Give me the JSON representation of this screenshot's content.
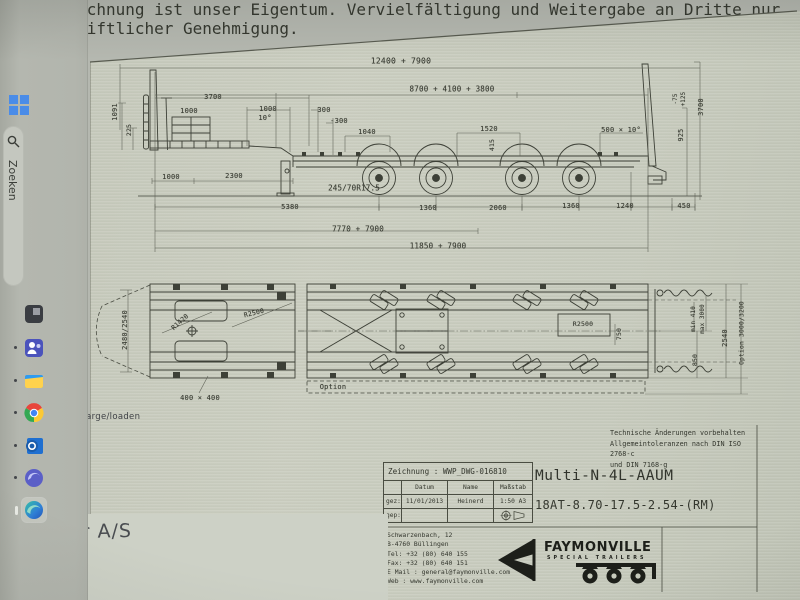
{
  "window": {
    "background": "#b5b8b0",
    "sheet": "#c7cbbd",
    "ink": "#3d4037",
    "accent_blue": "#4a8ce8"
  },
  "taskbar": {
    "search_label": "Zoeken",
    "items": [
      {
        "id": "start",
        "icon": "windows-logo",
        "active": false
      },
      {
        "id": "dark-app",
        "icon": "dark-app",
        "active": false
      },
      {
        "id": "teams",
        "icon": "teams",
        "active": false
      },
      {
        "id": "file-explorer",
        "icon": "file-explorer",
        "active": false
      },
      {
        "id": "chrome",
        "icon": "chrome",
        "active": false
      },
      {
        "id": "outlook",
        "icon": "outlook",
        "active": false
      },
      {
        "id": "edge-insider",
        "icon": "edge-insider",
        "active": false
      },
      {
        "id": "edge",
        "icon": "edge",
        "active": true
      }
    ]
  },
  "overlays": {
    "load_note": "laden/en charge/loaden",
    "partner_note": "artner A/S"
  },
  "drawing": {
    "notes": {
      "tolerances": "Technische Änderungen vorbehalten\nAllgemeintoleranzen nach DIN ISO 2768-c\nund DIN 7168-g"
    },
    "title_block": {
      "zeichnung": "Zeichnung : WWP_DWG-016810",
      "headers": {
        "datum": "Datum",
        "name": "Name",
        "massstab": "Maßstab"
      },
      "rows": {
        "gez_label": "gez:",
        "gez_date": "11/01/2013",
        "gez_name": "Heinerd",
        "scale": "1:50",
        "format": "A3",
        "gep_label": "gep:"
      },
      "model": "Multi-N-4L-AAUM",
      "spec": "18AT-8.70-17.5-2.54-(RM)"
    },
    "footer": {
      "address": "Schwarzenbach, 12\nB-4760 Büllingen\nTel: +32 (80) 640 155\nFax: +32 (80) 640 151\nE Mail : general@faymonville.com\nWeb : www.faymonville.com",
      "brand": {
        "name": "FAYMONVILLE",
        "tagline": "SPECIAL TRAILERS"
      },
      "ownership": "Diese Zeichnung ist unser Eigentum. Vervielfältigung und Weitergabe an Dritte nur nach schriftlicher Genehmigung."
    },
    "labels": [
      {
        "t": "12400 + 7900",
        "x": 401,
        "y": 61,
        "s": 8
      },
      {
        "t": "8700 + 4100 + 3800",
        "x": 452,
        "y": 89,
        "s": 7.5
      },
      {
        "t": "3700",
        "x": 213,
        "y": 97
      },
      {
        "t": "1091",
        "x": 115,
        "y": 112,
        "r": -90
      },
      {
        "t": "225",
        "x": 129,
        "y": 130,
        "r": -90,
        "s": 6.5
      },
      {
        "t": "1000",
        "x": 189,
        "y": 111
      },
      {
        "t": "1000",
        "x": 268,
        "y": 109
      },
      {
        "t": "10°",
        "x": 265,
        "y": 118
      },
      {
        "t": "300",
        "x": 324,
        "y": 110
      },
      {
        "t": "-300",
        "x": 339,
        "y": 121
      },
      {
        "t": "1040",
        "x": 367,
        "y": 132
      },
      {
        "t": "1520",
        "x": 489,
        "y": 129
      },
      {
        "t": "415",
        "x": 492,
        "y": 145,
        "r": -90,
        "s": 6.5
      },
      {
        "t": "500 × 10°",
        "x": 621,
        "y": 130
      },
      {
        "t": "-75",
        "x": 676,
        "y": 99,
        "r": -90,
        "s": 5.8
      },
      {
        "t": "+125",
        "x": 684,
        "y": 99,
        "r": -90,
        "s": 5.8
      },
      {
        "t": "925",
        "x": 681,
        "y": 135,
        "r": -90,
        "s": 6.8
      },
      {
        "t": "3700",
        "x": 701,
        "y": 107,
        "r": -90
      },
      {
        "t": "1000",
        "x": 171,
        "y": 177
      },
      {
        "t": "2300",
        "x": 234,
        "y": 176
      },
      {
        "t": "245/70R17.5",
        "x": 354,
        "y": 188,
        "s": 7.5
      },
      {
        "t": "5380",
        "x": 290,
        "y": 207
      },
      {
        "t": "1360",
        "x": 428,
        "y": 208
      },
      {
        "t": "2060",
        "x": 498,
        "y": 208
      },
      {
        "t": "1360",
        "x": 571,
        "y": 206
      },
      {
        "t": "1240",
        "x": 625,
        "y": 206
      },
      {
        "t": "450",
        "x": 684,
        "y": 206
      },
      {
        "t": "7770 + 7900",
        "x": 358,
        "y": 229,
        "s": 7.5
      },
      {
        "t": "11850 + 7900",
        "x": 438,
        "y": 246,
        "s": 7.5
      },
      {
        "t": "2480/2540",
        "x": 125,
        "y": 330,
        "r": -90
      },
      {
        "t": "R1420",
        "x": 180,
        "y": 322,
        "r": -42,
        "s": 6.5
      },
      {
        "t": "R2500",
        "x": 254,
        "y": 313,
        "r": -14,
        "s": 6.5
      },
      {
        "t": "400 × 400",
        "x": 200,
        "y": 398
      },
      {
        "t": "Option",
        "x": 333,
        "y": 387
      },
      {
        "t": "R2500",
        "x": 583,
        "y": 324,
        "s": 6.5
      },
      {
        "t": "750",
        "x": 619,
        "y": 334,
        "r": -90,
        "s": 6.5
      },
      {
        "t": "min 410",
        "x": 694,
        "y": 319,
        "r": -90,
        "s": 5.8
      },
      {
        "t": "max 3000",
        "x": 703,
        "y": 319,
        "r": -90,
        "s": 5.8
      },
      {
        "t": "850",
        "x": 695,
        "y": 360,
        "r": -90,
        "s": 6.5
      },
      {
        "t": "2540",
        "x": 725,
        "y": 338,
        "r": -90
      },
      {
        "t": "Option 3000/3200",
        "x": 742,
        "y": 333,
        "r": -90,
        "s": 6.3
      }
    ]
  }
}
